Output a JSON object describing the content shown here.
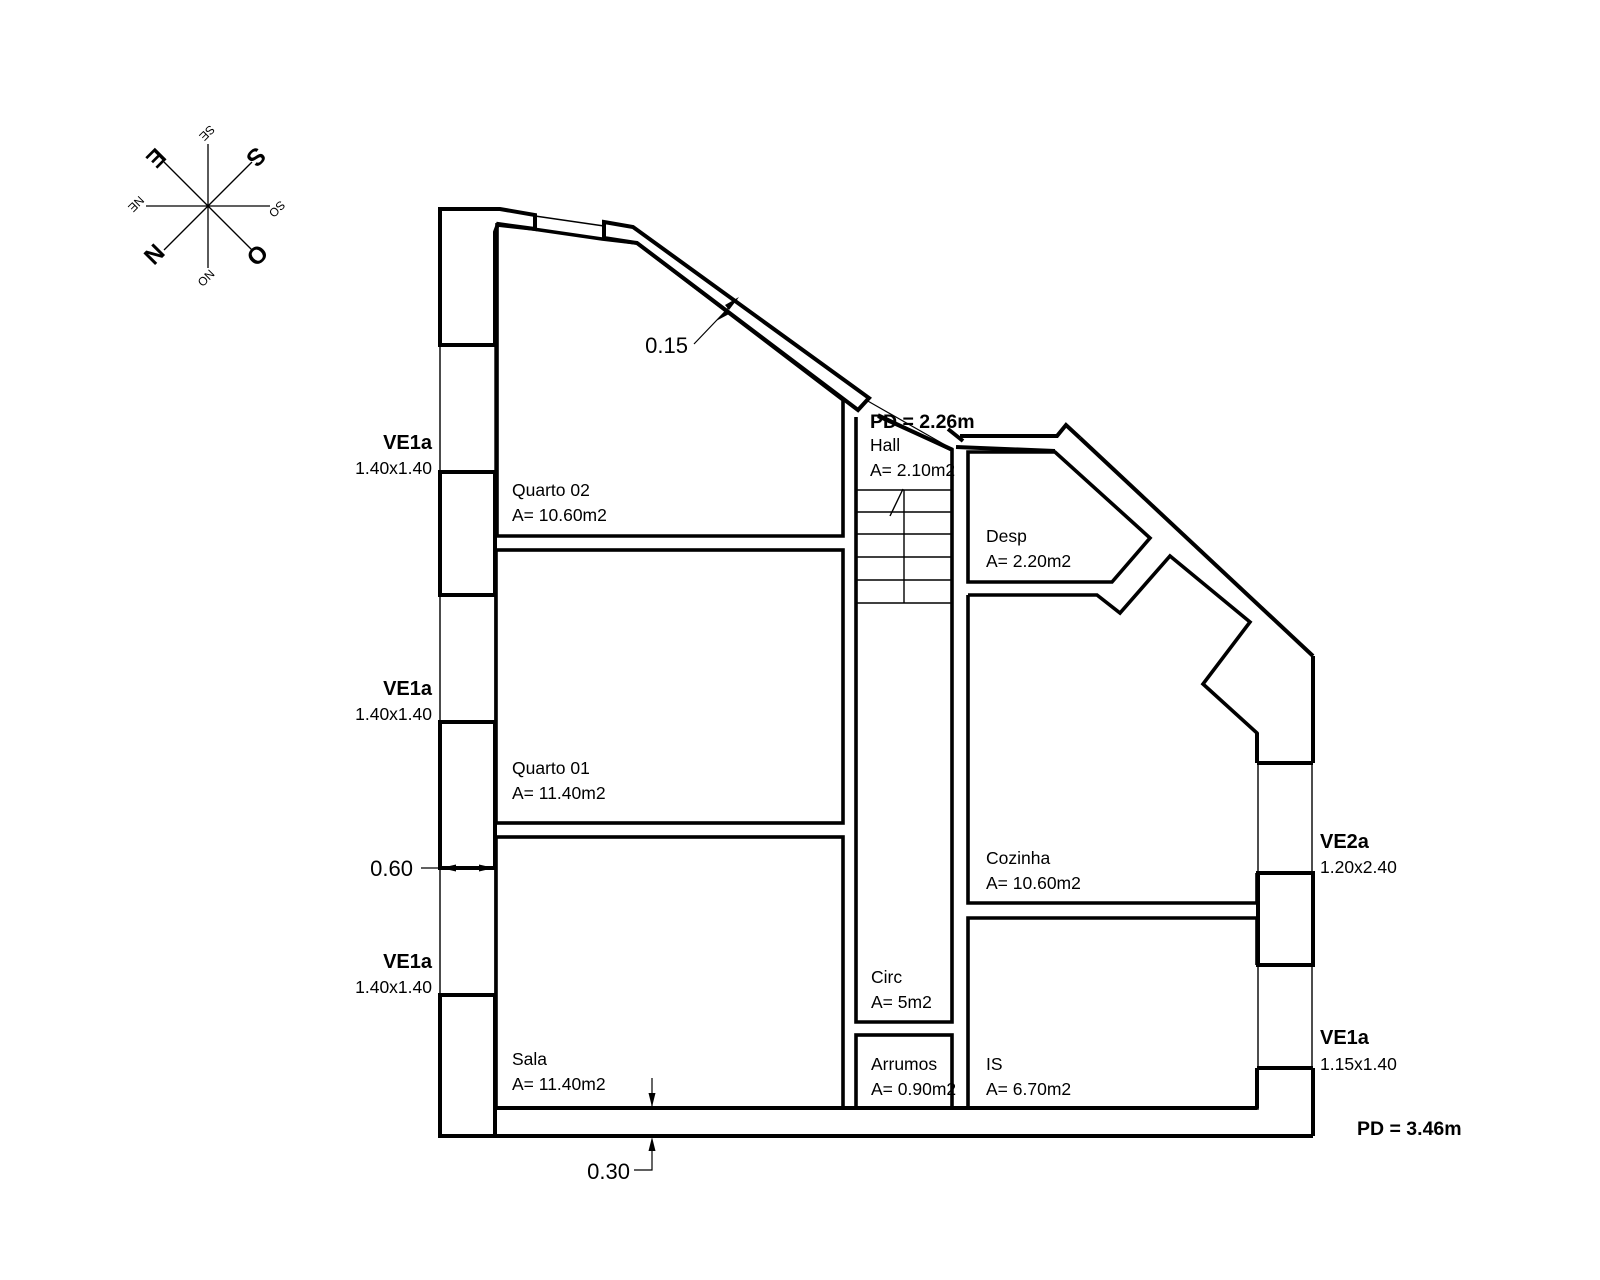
{
  "compass": {
    "cardinal_e": "E",
    "cardinal_s": "S",
    "cardinal_n": "N",
    "cardinal_o": "O",
    "inter_se": "SE",
    "inter_so": "SO",
    "inter_no": "NO",
    "inter_ne": "NE"
  },
  "rooms": [
    {
      "name": "Quarto 02",
      "area": "A= 10.60m2"
    },
    {
      "name": "Quarto 01",
      "area": "A= 11.40m2"
    },
    {
      "name": "Sala",
      "area": "A= 11.40m2"
    },
    {
      "name": "Hall",
      "area": "A= 2.10m2"
    },
    {
      "name": "Desp",
      "area": "A= 2.20m2"
    },
    {
      "name": "Cozinha",
      "area": "A= 10.60m2"
    },
    {
      "name": "Circ",
      "area": "A= 5m2"
    },
    {
      "name": "Arrumos",
      "area": "A= 0.90m2"
    },
    {
      "name": "IS",
      "area": "A= 6.70m2"
    }
  ],
  "windows": [
    {
      "code": "VE1a",
      "size": "1.40x1.40"
    },
    {
      "code": "VE1a",
      "size": "1.40x1.40"
    },
    {
      "code": "VE1a",
      "size": "1.40x1.40"
    },
    {
      "code": "VE2a",
      "size": "1.20x2.40"
    },
    {
      "code": "VE1a",
      "size": "1.15x1.40"
    }
  ],
  "dimensions": [
    {
      "value": "0.15"
    },
    {
      "value": "0.60"
    },
    {
      "value": "0.30"
    }
  ],
  "heights": {
    "upper_floor": "PD = 2.26m",
    "ground_floor": "PD = 3.46m"
  },
  "colors": {
    "dimension_red": "#C4303A",
    "line_black": "#000000"
  }
}
